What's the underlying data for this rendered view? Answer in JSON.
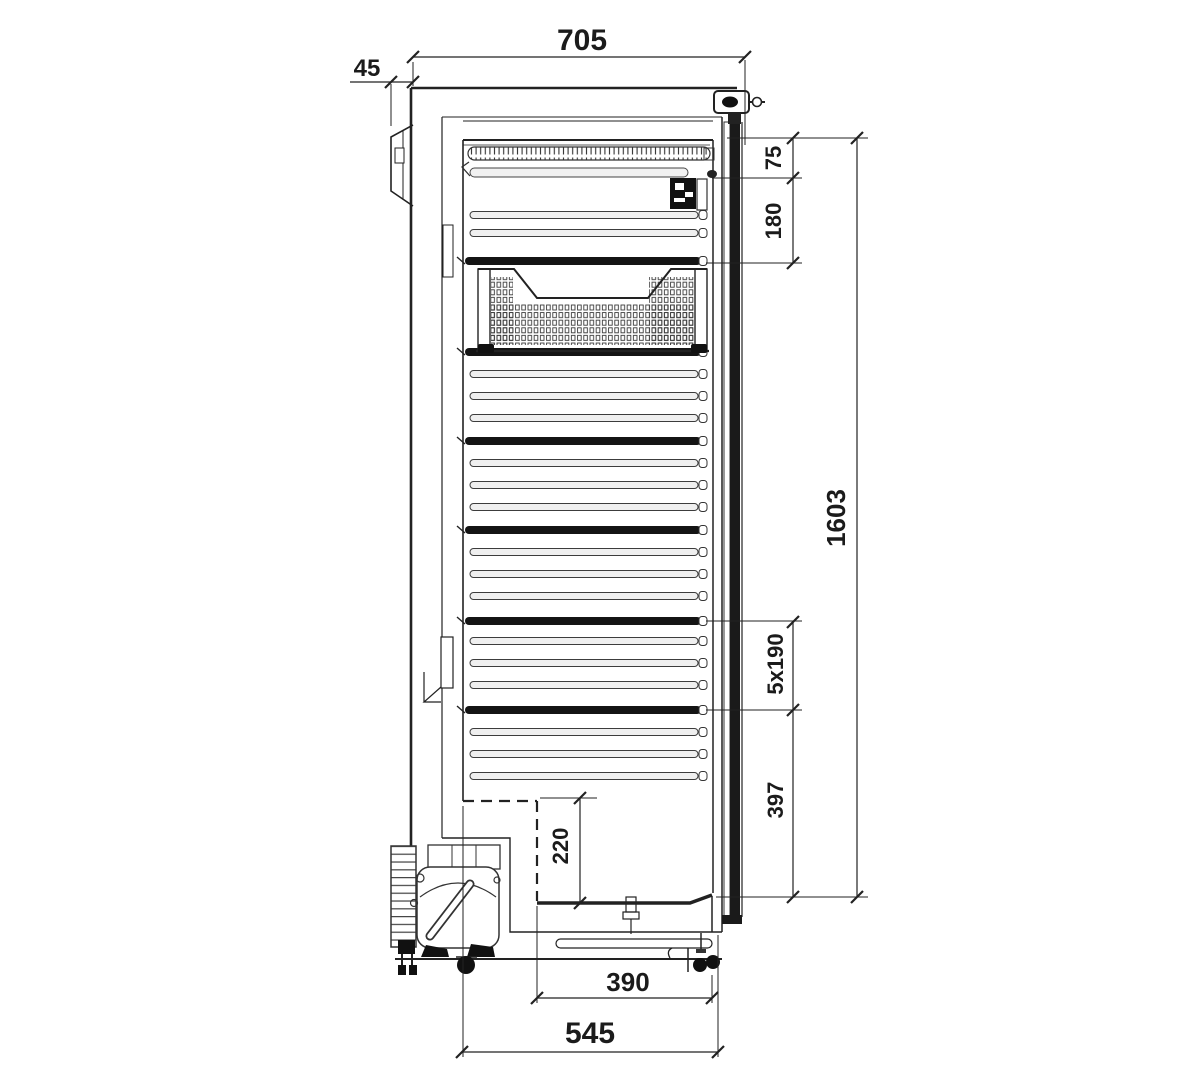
{
  "diagram": {
    "type": "technical-drawing",
    "subject": "Upright refrigerator cabinet side cross-section with shelf rails, wire basket and compressor unit",
    "unit": "mm",
    "dim_labels": {
      "top_depth": "705",
      "wall_spacer": "45",
      "top_clearance": "75",
      "first_shelf_offset": "180",
      "shelf_pitch": "5x190",
      "lower_section": "397",
      "overall_height": "1603",
      "recess_height": "220",
      "recess_depth": "390",
      "base_depth": "545"
    },
    "rails": {
      "thin_y": [
        215,
        233,
        374,
        396,
        418,
        463,
        485,
        507,
        552,
        574,
        596,
        641,
        663,
        685,
        732,
        754,
        776
      ],
      "bold_y": [
        261,
        352,
        441,
        530,
        621,
        710
      ]
    },
    "colors": {
      "line": "#222222",
      "dark": "#141414",
      "rail_fill": "#efefef"
    }
  }
}
